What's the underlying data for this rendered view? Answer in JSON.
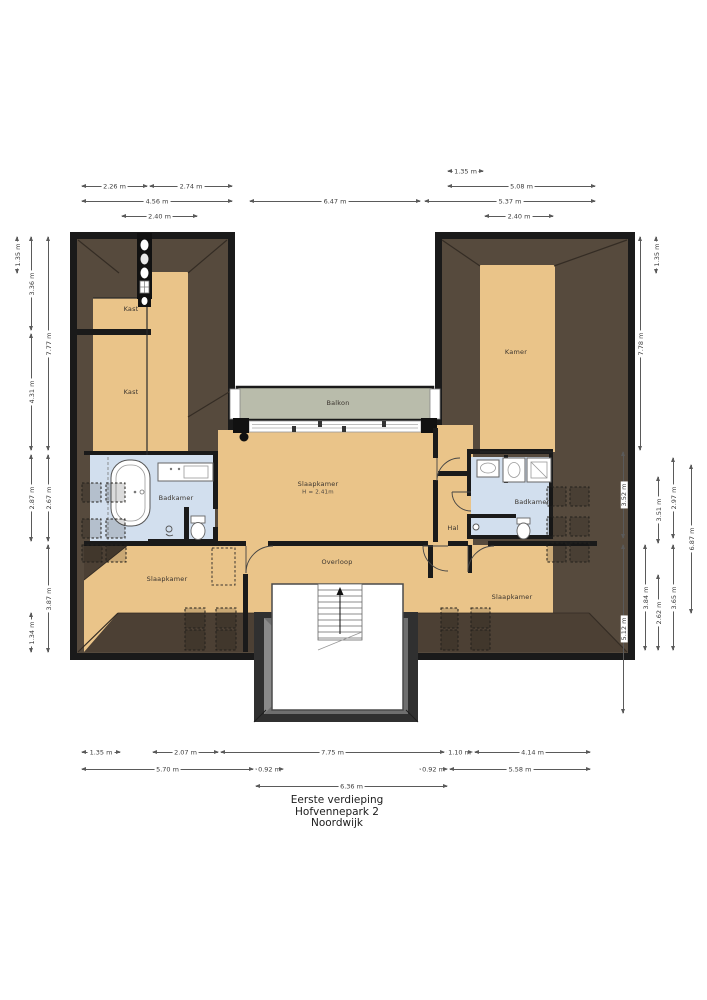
{
  "title": {
    "line1": "Eerste verdieping",
    "line2": "Hofvennepark 2",
    "line3": "Noordwijk"
  },
  "rooms": {
    "kast1": "Kast",
    "kast2": "Kast",
    "balkon": "Balkon",
    "kamer": "Kamer",
    "slaapkamer_center": "Slaapkamer",
    "slaapkamer_center_height": "H = 2.41m",
    "badkamer_left": "Badkamer",
    "badkamer_right": "Badkamer",
    "hal": "Hal",
    "overloop": "Overloop",
    "slaapkamer_left": "Slaapkamer",
    "slaapkamer_right": "Slaapkamer"
  },
  "dims": {
    "t1": "2.26 m",
    "t2": "2.74 m",
    "t3": "4.56 m",
    "t4": "2.40 m",
    "t5": "6.47 m",
    "t6": "1.35 m",
    "t7": "5.08 m",
    "t8": "5.37 m",
    "t9": "2.40 m",
    "l1": "1.35 m",
    "l2": "3.36 m",
    "l3": "7.77 m",
    "l4": "4.31 m",
    "l5": "2.87 m",
    "l6": "2.67 m",
    "l7": "3.87 m",
    "l8": "1.34 m",
    "r1": "7.78 m",
    "r2": "1.35 m",
    "r3": "3.52 m",
    "r4": "3.51 m",
    "r5": "2.97 m",
    "r6": "6.87 m",
    "r7": "5.12 m",
    "r8": "3.84 m",
    "r9": "2.62 m",
    "r10": "3.65 m",
    "b1": "1.35 m",
    "b2": "2.07 m",
    "b3": "7.75 m",
    "b4": "1.10 m",
    "b5": "4.14 m",
    "b6": "5.70 m",
    "b7": "0.92 m",
    "b8": "0.92 m",
    "b9": "5.58 m",
    "b10": "6.36 m"
  },
  "colors": {
    "wall": "#1a1a1a",
    "roof": "#564a3d",
    "roof_dark": "#4c4034",
    "floor": "#eac489",
    "bathroom": "#d2dfee",
    "balcony": "#b9bcab",
    "stair_gray": "#6f6f6f"
  }
}
